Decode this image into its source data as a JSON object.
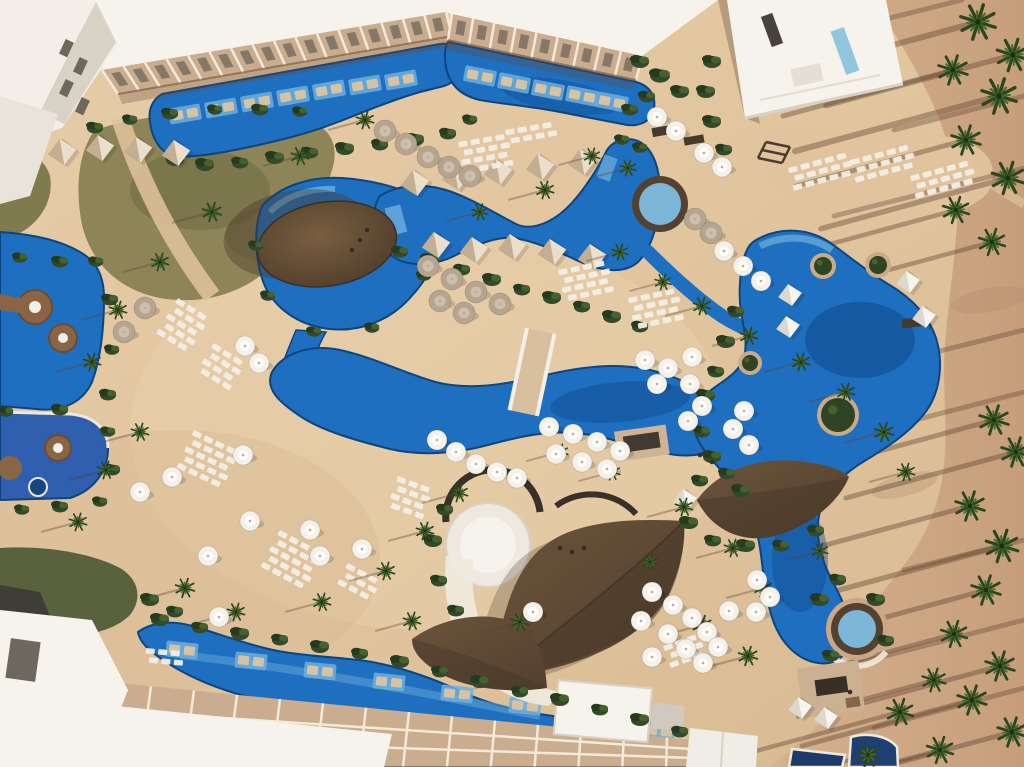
{
  "meta": {
    "title": "Aerial view — tropical resort pool complex",
    "description": "Drone photograph of a beach resort: winding blue swimming pools, thatched palapa roofs, white umbrellas, sun lounger rows, palm trees casting long shadows on sand, white hotel buildings."
  },
  "palette": {
    "sand": "#e2c7a1",
    "sandShade": "#d3b48e",
    "beach": "#d0aa87",
    "beachDark": "#bb9272",
    "shadow": "#5f4230",
    "pool": "#1f6fc0",
    "poolDeep": "#0e4686",
    "poolShelf": "#6fafdc",
    "poolEdge": "#0d457f",
    "spaRing": "#55412f",
    "spaWater": "#7cb6d8",
    "grass": "#8d8557",
    "grassDark": "#59623c",
    "bush": "#33492a",
    "bushDark": "#263a1e",
    "bushLight": "#45612f",
    "palm": "#2b471f",
    "palmLight": "#4a692d",
    "roofBrown": "#5f4a37",
    "roofBrownDk": "#48382a",
    "roofSeam": "#3c2f22",
    "white": "#f6f3ed",
    "whiteDim": "#e9e4da",
    "facade": "#c9ad8e",
    "facadeLine": "#f3ead9",
    "windowDark": "#6e675c",
    "umbrella": "#f4f1ea",
    "umbrellaTaupe": "#b5a48f",
    "lounger": "#f2efe7",
    "loungerTan": "#d6c3a4",
    "cabana": "#c4ae92",
    "cabanaLight": "#eadfca",
    "cabanaWhite": "#f7f5f0",
    "platBrown": "#8a6545",
    "bridge": "#d8bf9e",
    "navy": "#1d3a6b"
  },
  "scene": {
    "umbrellas_white": [
      [
        645,
        360
      ],
      [
        668,
        368
      ],
      [
        692,
        357
      ],
      [
        657,
        384
      ],
      [
        690,
        384
      ],
      [
        702,
        406
      ],
      [
        688,
        421
      ],
      [
        549,
        427
      ],
      [
        573,
        434
      ],
      [
        597,
        442
      ],
      [
        620,
        451
      ],
      [
        556,
        454
      ],
      [
        582,
        462
      ],
      [
        607,
        469
      ],
      [
        437,
        440
      ],
      [
        456,
        452
      ],
      [
        476,
        464
      ],
      [
        497,
        472
      ],
      [
        517,
        478
      ],
      [
        652,
        592
      ],
      [
        673,
        605
      ],
      [
        692,
        618
      ],
      [
        707,
        632
      ],
      [
        668,
        634
      ],
      [
        686,
        649
      ],
      [
        703,
        663
      ],
      [
        652,
        657
      ],
      [
        718,
        647
      ],
      [
        729,
        611
      ],
      [
        641,
        621
      ],
      [
        744,
        411
      ],
      [
        733,
        429
      ],
      [
        749,
        445
      ],
      [
        724,
        251
      ],
      [
        743,
        266
      ],
      [
        761,
        281
      ],
      [
        757,
        580
      ],
      [
        770,
        597
      ],
      [
        756,
        612
      ],
      [
        657,
        117
      ],
      [
        676,
        131
      ],
      [
        704,
        153
      ],
      [
        722,
        167
      ],
      [
        243,
        455
      ],
      [
        250,
        521
      ],
      [
        140,
        492
      ],
      [
        172,
        477
      ],
      [
        208,
        556
      ],
      [
        310,
        530
      ],
      [
        320,
        556
      ],
      [
        245,
        346
      ],
      [
        259,
        363
      ],
      [
        362,
        549
      ],
      [
        533,
        612
      ],
      [
        219,
        617
      ]
    ],
    "umbrellas_taupe": [
      [
        385,
        131
      ],
      [
        406,
        144
      ],
      [
        428,
        157
      ],
      [
        449,
        167
      ],
      [
        470,
        176
      ],
      [
        428,
        266
      ],
      [
        452,
        279
      ],
      [
        476,
        292
      ],
      [
        500,
        304
      ],
      [
        440,
        301
      ],
      [
        464,
        313
      ],
      [
        695,
        219
      ],
      [
        711,
        233
      ],
      [
        145,
        308
      ],
      [
        124,
        332
      ]
    ],
    "cabanas_beige": [
      [
        415,
        183
      ],
      [
        456,
        177
      ],
      [
        498,
        172
      ],
      [
        540,
        167
      ],
      [
        582,
        162
      ],
      [
        436,
        245
      ],
      [
        474,
        250
      ],
      [
        512,
        247
      ],
      [
        552,
        252
      ],
      [
        592,
        257
      ],
      [
        62,
        152
      ],
      [
        100,
        148
      ],
      [
        138,
        150
      ],
      [
        176,
        153
      ]
    ],
    "cabanas_white": [
      [
        790,
        295
      ],
      [
        788,
        327
      ],
      [
        908,
        282
      ],
      [
        924,
        317
      ],
      [
        800,
        708
      ],
      [
        826,
        718
      ],
      [
        685,
        500
      ]
    ],
    "planters": [
      [
        823,
        266,
        13
      ],
      [
        878,
        265,
        13
      ],
      [
        838,
        415,
        21
      ],
      [
        750,
        363,
        12
      ]
    ],
    "lounger_grids": [
      {
        "x": 458,
        "y": 142,
        "rows": 4,
        "cols": 4,
        "rot": -10
      },
      {
        "x": 505,
        "y": 130,
        "rows": 2,
        "cols": 4,
        "rot": -10
      },
      {
        "x": 788,
        "y": 168,
        "rows": 3,
        "cols": 5,
        "rot": -15
      },
      {
        "x": 850,
        "y": 160,
        "rows": 3,
        "cols": 5,
        "rot": -15
      },
      {
        "x": 910,
        "y": 176,
        "rows": 3,
        "cols": 5,
        "rot": -15
      },
      {
        "x": 178,
        "y": 298,
        "rows": 5,
        "cols": 3,
        "rot": 32
      },
      {
        "x": 214,
        "y": 343,
        "rows": 4,
        "cols": 3,
        "rot": 32
      },
      {
        "x": 194,
        "y": 430,
        "rows": 5,
        "cols": 4,
        "rot": 25
      },
      {
        "x": 558,
        "y": 270,
        "rows": 4,
        "cols": 4,
        "rot": -12
      },
      {
        "x": 628,
        "y": 298,
        "rows": 4,
        "cols": 4,
        "rot": -12
      },
      {
        "x": 280,
        "y": 530,
        "rows": 5,
        "cols": 4,
        "rot": 28
      },
      {
        "x": 348,
        "y": 563,
        "rows": 3,
        "cols": 3,
        "rot": 28
      },
      {
        "x": 398,
        "y": 476,
        "rows": 4,
        "cols": 3,
        "rot": 20
      },
      {
        "x": 663,
        "y": 646,
        "rows": 3,
        "cols": 3,
        "rot": -20
      },
      {
        "x": 146,
        "y": 648,
        "rows": 2,
        "cols": 3,
        "rot": 5
      }
    ],
    "pool_platforms": [
      [
        185,
        114,
        -10
      ],
      [
        221,
        108,
        -10
      ],
      [
        257,
        102,
        -10
      ],
      [
        293,
        96,
        -10
      ],
      [
        329,
        90,
        -10
      ],
      [
        365,
        85,
        -10
      ],
      [
        401,
        80,
        -10
      ],
      [
        480,
        76,
        11
      ],
      [
        514,
        83,
        11
      ],
      [
        548,
        90,
        11
      ],
      [
        582,
        96,
        11
      ],
      [
        612,
        102,
        11
      ],
      [
        182,
        650,
        6
      ],
      [
        251,
        661,
        6
      ],
      [
        320,
        671,
        6
      ],
      [
        389,
        682,
        6
      ],
      [
        457,
        694,
        6
      ],
      [
        525,
        706,
        6
      ],
      [
        593,
        719,
        6
      ],
      [
        659,
        731,
        6
      ]
    ],
    "palms_beach": [
      [
        978,
        22,
        1.2
      ],
      [
        1013,
        55,
        1.1
      ],
      [
        953,
        70,
        1.0
      ],
      [
        999,
        96,
        1.2
      ],
      [
        966,
        140,
        1.0
      ],
      [
        1008,
        178,
        1.1
      ],
      [
        956,
        210,
        0.9
      ],
      [
        992,
        242,
        0.9
      ],
      [
        994,
        420,
        1.0
      ],
      [
        1016,
        452,
        1.0
      ],
      [
        970,
        506,
        1.0
      ],
      [
        1002,
        546,
        1.1
      ],
      [
        986,
        590,
        1.0
      ],
      [
        954,
        634,
        0.9
      ],
      [
        1000,
        666,
        1.0
      ],
      [
        972,
        700,
        1.0
      ],
      [
        1012,
        732,
        1.0
      ],
      [
        940,
        750,
        0.9
      ],
      [
        900,
        712,
        0.9
      ],
      [
        934,
        680,
        0.8
      ],
      [
        868,
        755,
        0.8
      ]
    ],
    "palms_inner": [
      [
        365,
        120,
        0.6
      ],
      [
        300,
        156,
        0.6
      ],
      [
        212,
        212,
        0.65
      ],
      [
        160,
        262,
        0.6
      ],
      [
        118,
        310,
        0.6
      ],
      [
        92,
        362,
        0.6
      ],
      [
        140,
        432,
        0.6
      ],
      [
        106,
        470,
        0.6
      ],
      [
        78,
        522,
        0.6
      ],
      [
        185,
        588,
        0.65
      ],
      [
        236,
        612,
        0.6
      ],
      [
        322,
        602,
        0.6
      ],
      [
        386,
        571,
        0.6
      ],
      [
        425,
        531,
        0.6
      ],
      [
        459,
        493,
        0.6
      ],
      [
        520,
        622,
        0.6
      ],
      [
        560,
        452,
        0.55
      ],
      [
        612,
        472,
        0.55
      ],
      [
        684,
        507,
        0.6
      ],
      [
        733,
        548,
        0.6
      ],
      [
        763,
        588,
        0.6
      ],
      [
        820,
        551,
        0.55
      ],
      [
        650,
        562,
        0.55
      ],
      [
        702,
        625,
        0.65
      ],
      [
        748,
        656,
        0.65
      ],
      [
        412,
        621,
        0.6
      ],
      [
        545,
        190,
        0.6
      ],
      [
        480,
        212,
        0.55
      ],
      [
        592,
        156,
        0.55
      ],
      [
        628,
        168,
        0.55
      ],
      [
        702,
        306,
        0.6
      ],
      [
        749,
        336,
        0.6
      ],
      [
        801,
        362,
        0.6
      ],
      [
        846,
        392,
        0.6
      ],
      [
        884,
        432,
        0.65
      ],
      [
        906,
        472,
        0.6
      ],
      [
        620,
        252,
        0.55
      ],
      [
        663,
        282,
        0.55
      ]
    ],
    "beach_shadow_lines": [
      [
        1024,
        168,
        -190,
        48
      ],
      [
        1024,
        330,
        -160,
        40
      ],
      [
        1024,
        392,
        -140,
        36
      ],
      [
        1024,
        620,
        -170,
        44
      ],
      [
        1024,
        688,
        -150,
        40
      ],
      [
        1024,
        96,
        -130,
        34
      ],
      [
        962,
        0,
        -120,
        30
      ],
      [
        1024,
        540,
        -120,
        30
      ]
    ],
    "bushes": [
      [
        175,
        160,
        1
      ],
      [
        205,
        165,
        1
      ],
      [
        240,
        163,
        0.9
      ],
      [
        275,
        158,
        1
      ],
      [
        310,
        153,
        0.9
      ],
      [
        345,
        149,
        1
      ],
      [
        380,
        145,
        0.9
      ],
      [
        415,
        140,
        1
      ],
      [
        448,
        134,
        0.9
      ],
      [
        470,
        120,
        0.8
      ],
      [
        400,
        252,
        0.9
      ],
      [
        430,
        260,
        1
      ],
      [
        462,
        270,
        0.9
      ],
      [
        492,
        280,
        1
      ],
      [
        522,
        290,
        0.9
      ],
      [
        552,
        298,
        1
      ],
      [
        582,
        307,
        0.9
      ],
      [
        612,
        317,
        1
      ],
      [
        640,
        327,
        0.9
      ],
      [
        736,
        312,
        0.9
      ],
      [
        726,
        342,
        1
      ],
      [
        716,
        372,
        0.9
      ],
      [
        706,
        396,
        1
      ],
      [
        702,
        432,
        0.9
      ],
      [
        712,
        457,
        1
      ],
      [
        727,
        474,
        0.9
      ],
      [
        741,
        491,
        1
      ],
      [
        820,
        600,
        1
      ],
      [
        838,
        580,
        0.9
      ],
      [
        876,
        600,
        1
      ],
      [
        886,
        641,
        0.9
      ],
      [
        831,
        656,
        0.9
      ],
      [
        700,
        481,
        0.9
      ],
      [
        689,
        523,
        1
      ],
      [
        713,
        541,
        0.9
      ],
      [
        746,
        546,
        1
      ],
      [
        781,
        546,
        0.9
      ],
      [
        816,
        531,
        0.9
      ],
      [
        160,
        620,
        1
      ],
      [
        200,
        628,
        0.9
      ],
      [
        240,
        634,
        1
      ],
      [
        280,
        640,
        0.9
      ],
      [
        320,
        647,
        1
      ],
      [
        360,
        654,
        0.9
      ],
      [
        400,
        662,
        1
      ],
      [
        440,
        672,
        0.9
      ],
      [
        480,
        682,
        1
      ],
      [
        520,
        692,
        0.9
      ],
      [
        560,
        700,
        1
      ],
      [
        600,
        710,
        0.9
      ],
      [
        640,
        720,
        1
      ],
      [
        680,
        732,
        0.9
      ],
      [
        445,
        510,
        0.9
      ],
      [
        433,
        541,
        1
      ],
      [
        439,
        581,
        0.9
      ],
      [
        456,
        611,
        0.9
      ],
      [
        20,
        258,
        0.8
      ],
      [
        60,
        262,
        0.9
      ],
      [
        96,
        262,
        0.8
      ],
      [
        110,
        300,
        0.9
      ],
      [
        112,
        350,
        0.8
      ],
      [
        108,
        395,
        0.9
      ],
      [
        6,
        412,
        0.8
      ],
      [
        60,
        410,
        0.9
      ],
      [
        108,
        432,
        0.8
      ],
      [
        112,
        470,
        0.9
      ],
      [
        100,
        502,
        0.8
      ],
      [
        60,
        507,
        0.9
      ],
      [
        22,
        510,
        0.8
      ],
      [
        95,
        128,
        0.9
      ],
      [
        130,
        120,
        0.8
      ],
      [
        170,
        114,
        0.9
      ],
      [
        215,
        110,
        0.8
      ],
      [
        260,
        110,
        0.9
      ],
      [
        300,
        112,
        0.8
      ],
      [
        640,
        62,
        1
      ],
      [
        660,
        76,
        1.1
      ],
      [
        680,
        92,
        1
      ],
      [
        647,
        97,
        0.9
      ],
      [
        630,
        110,
        0.9
      ],
      [
        712,
        62,
        1
      ],
      [
        706,
        92,
        1
      ],
      [
        712,
        122,
        1
      ],
      [
        724,
        150,
        0.9
      ],
      [
        150,
        600,
        1
      ],
      [
        175,
        612,
        0.9
      ],
      [
        640,
        148,
        0.8
      ],
      [
        622,
        140,
        0.8
      ],
      [
        256,
        246,
        0.8
      ],
      [
        268,
        296,
        0.8
      ],
      [
        314,
        332,
        0.8
      ],
      [
        372,
        328,
        0.8
      ],
      [
        424,
        276,
        0.8
      ]
    ],
    "people": [
      [
        560,
        548
      ],
      [
        572,
        552
      ],
      [
        584,
        548
      ],
      [
        700,
        455
      ],
      [
        712,
        462
      ],
      [
        838,
        688
      ],
      [
        850,
        692
      ],
      [
        352,
        250
      ],
      [
        360,
        240
      ],
      [
        367,
        230
      ]
    ],
    "facades": [
      {
        "pts": [
          [
            102,
            70
          ],
          [
            446,
            12
          ],
          [
            452,
            36
          ],
          [
            118,
            94
          ]
        ],
        "n": 16,
        "windows": true
      },
      {
        "pts": [
          [
            452,
            14
          ],
          [
            642,
            56
          ],
          [
            636,
            80
          ],
          [
            448,
            40
          ]
        ],
        "n": 9,
        "windows": true
      },
      {
        "pts": [
          [
            108,
            682
          ],
          [
            710,
            742
          ],
          [
            710,
            767
          ],
          [
            96,
            767
          ]
        ],
        "n": 14,
        "windows": false,
        "hlines": true
      }
    ]
  }
}
